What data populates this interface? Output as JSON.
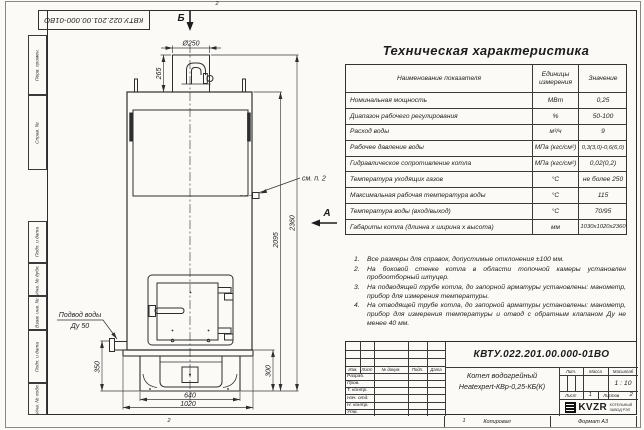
{
  "frame": {
    "doc_number_rotated": "КВТУ.022.201.00.000-01ВО",
    "sidebar_fields": [
      "Перв. примен.",
      "Справ. №",
      "Подп. и дата",
      "Инв. № дубл.",
      "Взам. инв. №",
      "Подп. и дата",
      "Инв. № подл."
    ],
    "zone_top": "2",
    "zone_bottom_left": "2",
    "zone_bottom_right": "1",
    "copied_label": "Копировал",
    "format_label": "Формат А3"
  },
  "drawing": {
    "view_b_label": "Б",
    "view_a_label": "А",
    "callout": "см. п. 2",
    "water_inlet_line1": "Подвод воды",
    "water_inlet_line2": "Ду 50",
    "dims": {
      "chimney_diameter": "Ø250",
      "chimney_height": "265",
      "total_height": "2360",
      "body_height": "2095",
      "inlet_height": "350",
      "base_height": "300",
      "pedestal_width": "640",
      "base_width": "1020"
    }
  },
  "spec_table": {
    "title": "Техническая характеристика",
    "headers": [
      "Наименование показателя",
      "Единицы измерения",
      "Значение"
    ],
    "rows": [
      [
        "Номинальная мощность",
        "МВт",
        "0,25"
      ],
      [
        "Диапазон рабочего регулирования",
        "%",
        "50-100"
      ],
      [
        "Расход воды",
        "м³/ч",
        "9"
      ],
      [
        "Рабочее давление воды",
        "МПа (кгс/см²)",
        "0,3(3,0)-0,6(6,0)"
      ],
      [
        "Гидравлическое сопротивление котла",
        "МПа (кгс/см²)",
        "0,02(0,2)"
      ],
      [
        "Температура уходящих газов",
        "°С",
        "не более 250"
      ],
      [
        "Максимальная рабочая температура воды",
        "°С",
        "115"
      ],
      [
        "Температура воды (вход/выход)",
        "°С",
        "70/95"
      ],
      [
        "Габариты котла (длинна х ширина х высота)",
        "мм",
        "1030х1020х2360"
      ]
    ]
  },
  "notes": {
    "items": [
      {
        "num": "1.",
        "text": "Все размеры для справок, допустимые отклонения ±100 мм."
      },
      {
        "num": "2.",
        "text": "На боковой стенке котла в области топочной камеры установлен пробоотборный штуцер."
      },
      {
        "num": "3.",
        "text": "На подводящей трубе котла, до запорной арматуры установлены: манометр, прибор для измерения температуры."
      },
      {
        "num": "4.",
        "text": "На отводящей трубе котла, до запорной арматуры установлены: манометр, прибор для измерения температуры и отвод с обратным клапаном Ду не менее 40 мм."
      }
    ]
  },
  "title_block": {
    "doc_number": "КВТУ.022.201.00.000-01ВО",
    "header_cols": [
      "Изм.",
      "Лист",
      "№ докум.",
      "Подп.",
      "Дата"
    ],
    "row_labels": [
      "Разраб.",
      "Пров.",
      "Т. контр.",
      "Нач. отд.",
      "Н. контр.",
      "Утв."
    ],
    "product_line1": "Котел водогрейный",
    "product_line2": "Heatexpert-КВр-0,25-КБ(К)",
    "lit_label": "Лит.",
    "mass_label": "Масса",
    "scale_label": "Масштаб",
    "scale_value": "1 : 10",
    "sheet_label": "Лист",
    "sheet_value": "1",
    "sheets_label": "Листов",
    "sheets_value": "2",
    "logo_text": "KVZR",
    "company_line1": "КОТЕЛЬНЫЙ",
    "company_line2": "ЗАВОД РЭП"
  }
}
